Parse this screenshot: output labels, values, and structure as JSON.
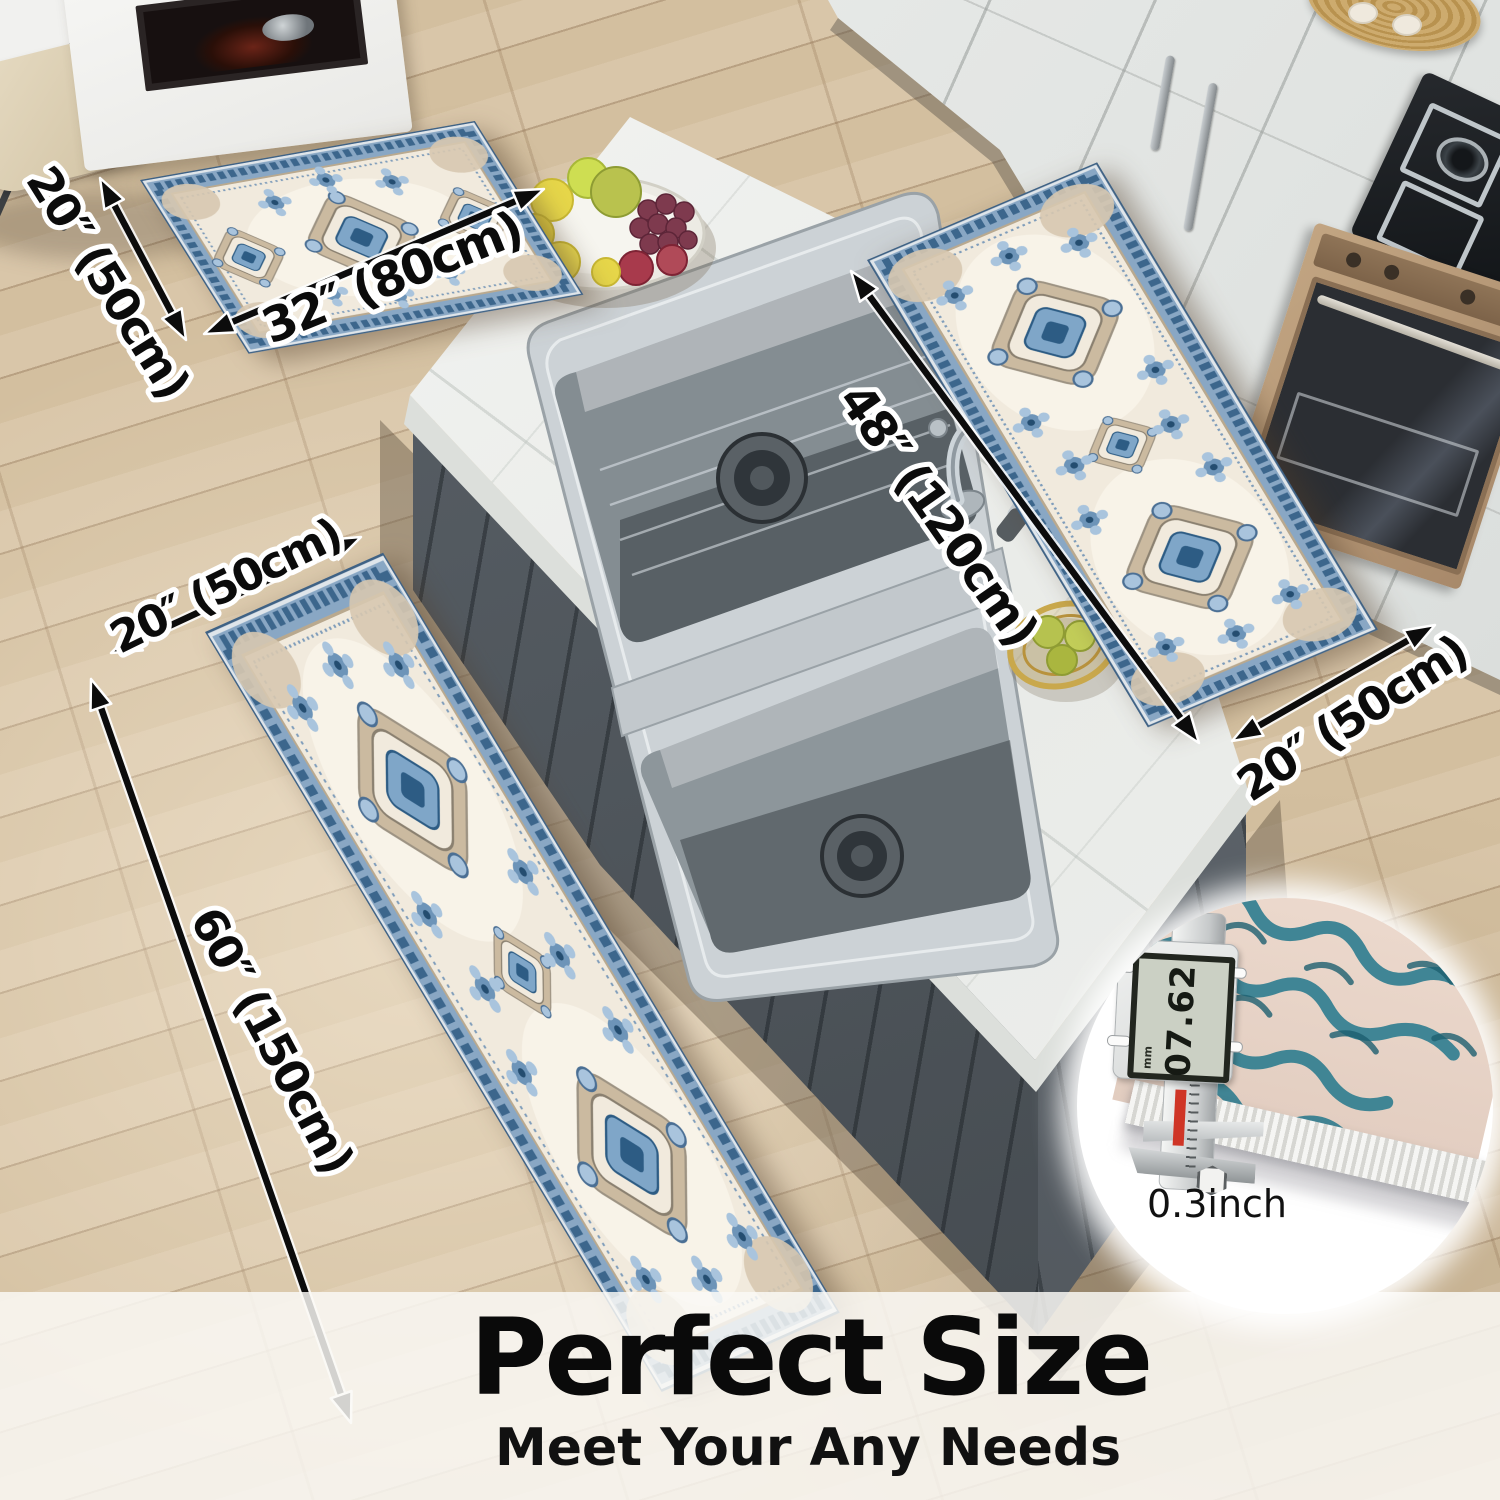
{
  "page": {
    "heading": "Perfect Size",
    "subheading": "Meet Your Any Needs"
  },
  "dimension_labels": {
    "mat_width": "20″ (50cm)",
    "mat_length": "32″ (80cm)",
    "runner_right_length": "48″ (120cm)",
    "runner_right_width": "20″ (50cm)",
    "runner_left_width": "20″ (50cm)",
    "runner_left_length": "60″ (150cm)"
  },
  "thickness_inset": {
    "caliper_reading": "07.62",
    "caliper_unit": "mm",
    "thickness_label": "0.3inch"
  },
  "colors": {
    "arrow_black": "#0c0c0c",
    "label_fill": "#0b0b0b",
    "label_outline": "#ffffff",
    "rug_field_cream": "#f1eadd",
    "rug_border_blue": "#89a7c4",
    "rug_blue_deep": "#2d5c84",
    "floor_wood": "#d5c1a3",
    "island_marble": "#f1f2f0",
    "island_base_gray": "#545b61",
    "overlay_band": "rgba(250,249,246,0.84)"
  }
}
